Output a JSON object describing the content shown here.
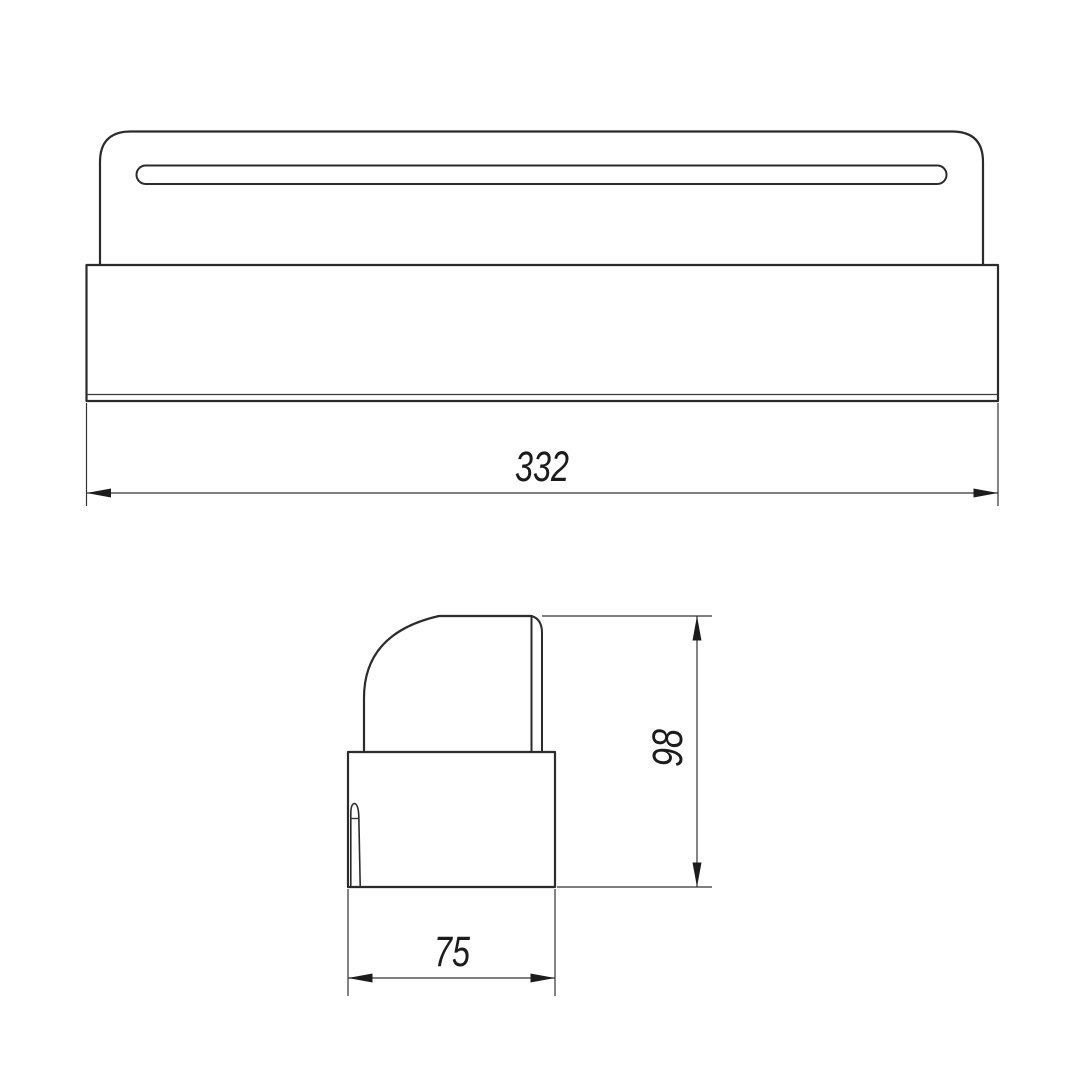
{
  "drawing": {
    "type": "technical-drawing",
    "colors": {
      "background": "#ffffff",
      "line": "#2b2b2b",
      "text": "#1c1c1c"
    },
    "views": {
      "front": {
        "description": "front view of slotted bracket cover on base plate",
        "dimension_width": {
          "value": "332"
        }
      },
      "side": {
        "description": "side profile view with rounded cap on base block",
        "dimension_height": {
          "value": "98"
        },
        "dimension_depth": {
          "value": "75"
        }
      }
    }
  }
}
